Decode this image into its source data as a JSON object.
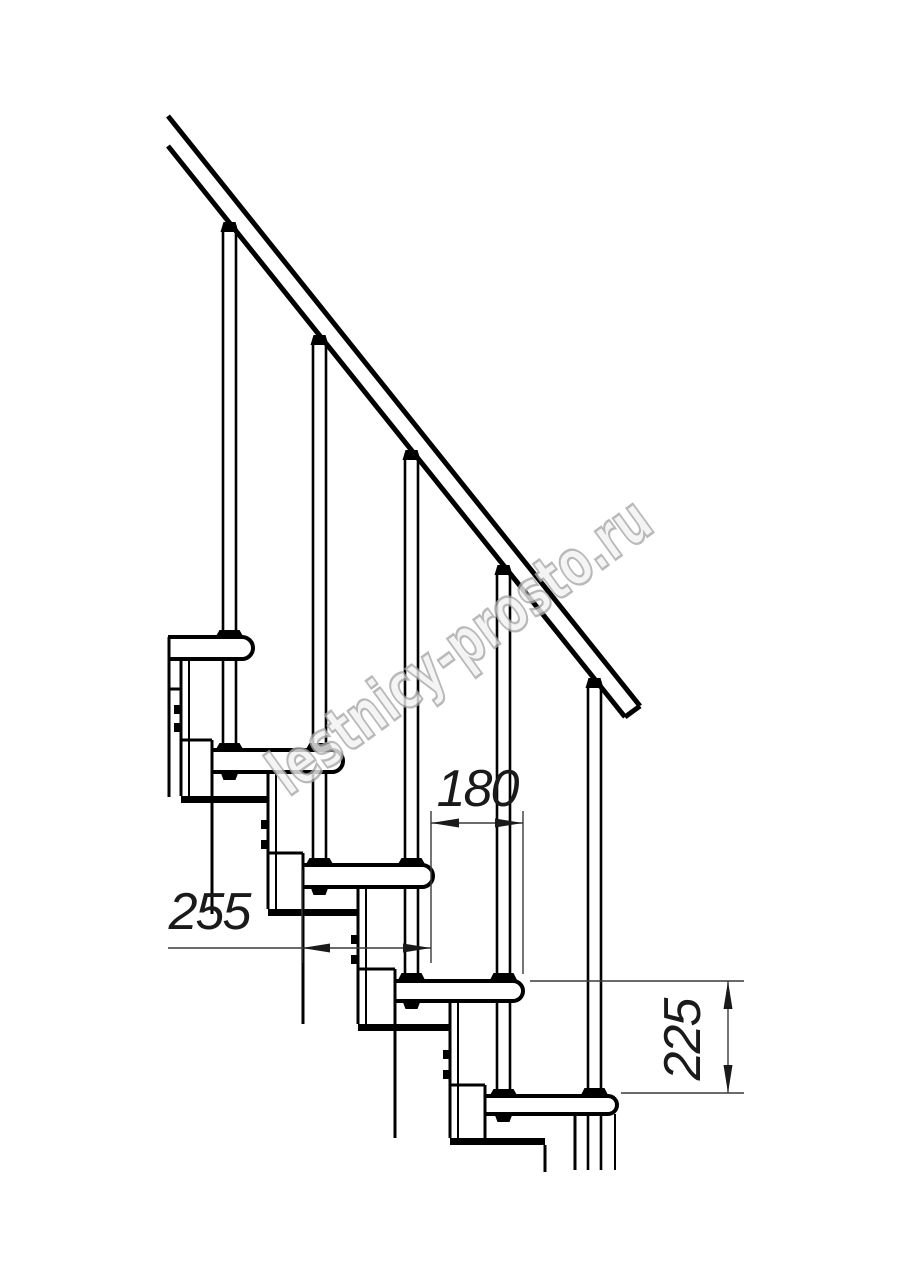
{
  "drawing": {
    "type": "staircase-side-elevation",
    "watermark": {
      "text": "lestnicy-prosto.ru"
    },
    "dimensions": {
      "step_going": {
        "label": "180"
      },
      "tread_depth": {
        "label": "255"
      },
      "step_rise": {
        "label": "225"
      }
    },
    "colors": {
      "line": "#000000",
      "dimension": "#3a3a3a",
      "watermark_stroke": "#a8a8a8",
      "watermark_fill": "#f2f2f2",
      "background": "#ffffff"
    }
  }
}
